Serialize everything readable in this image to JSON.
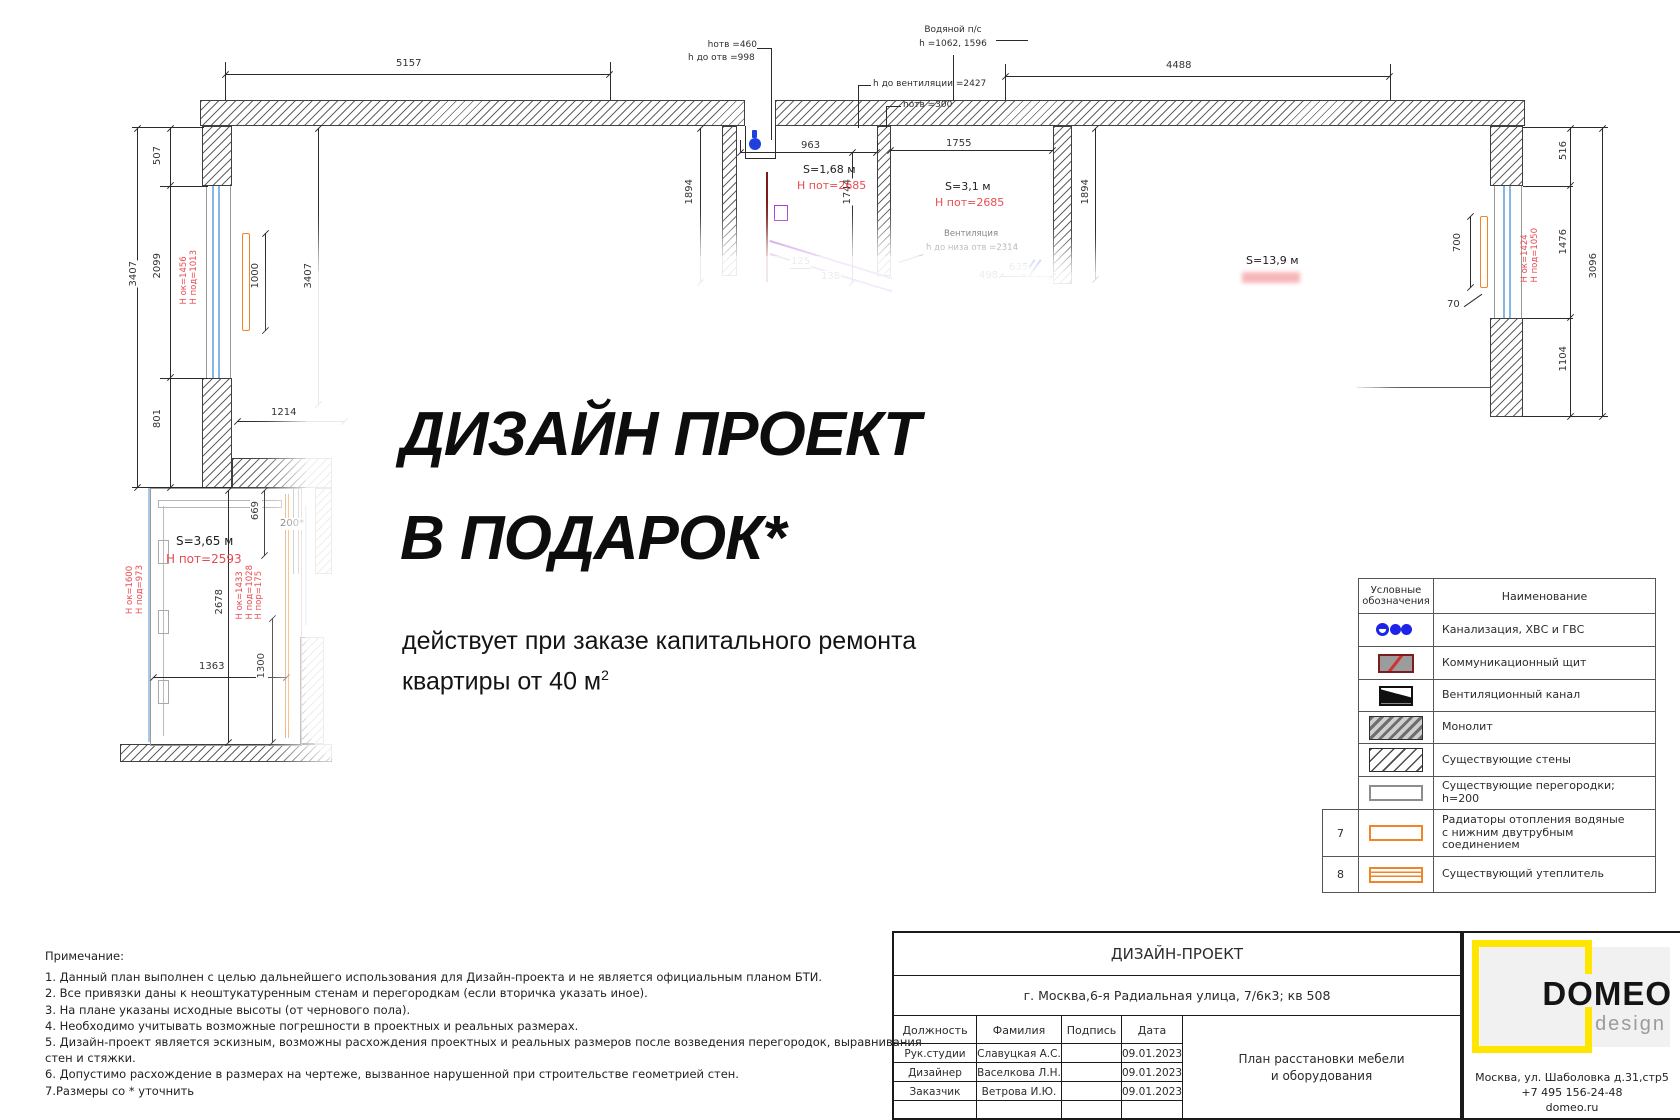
{
  "overlay": {
    "title_line1": "ДИЗАЙН ПРОЕКТ",
    "title_line2": "В ПОДАРОК*",
    "subtitle_line1": "действует при заказе капитального ремонта",
    "subtitle_line2": "квартиры от 40 м",
    "subtitle_sup": "2"
  },
  "plan": {
    "dims": {
      "d5157": "5157",
      "d4488": "4488",
      "d3407l": "3407",
      "d507": "507",
      "d2099": "2099",
      "d801": "801",
      "d3407i": "3407",
      "d1214": "1214",
      "d963": "963",
      "d1755": "1755",
      "d1894a": "1894",
      "d1744": "1744",
      "d1894b": "1894",
      "d635": "635",
      "d125": "125",
      "d138": "138",
      "d498": "498",
      "d516": "516",
      "d1476": "1476",
      "d1104": "1104",
      "d3096": "3096",
      "d700": "700",
      "d70": "70",
      "d1000": "1000",
      "d669": "669",
      "d200": "200*",
      "d2678": "2678",
      "d1363": "1363",
      "d1300": "1300"
    },
    "rooms": {
      "bath_s": "S=1,68 м",
      "bath_h": "Н пот=2685",
      "wc_s": "S=3,1 м",
      "wc_h": "Н пот=2685",
      "living_s": "S=13,9 м",
      "balcony_s": "S=3,65 м",
      "balcony_h": "Н пот=2593"
    },
    "red_marks": {
      "lw1": "Н ок=1456",
      "lw2": "Н под=1013",
      "bl1": "Н ок=1600",
      "bl2": "Н под=973",
      "bm1": "Н ок=1433",
      "bm2": "Н под=1028",
      "bm3": "Н пор=175",
      "rw1": "Н ок=1424",
      "rw2": "Н под=1050"
    },
    "annotations": {
      "a1a": "hотв =460",
      "a1b": "h до отв =998",
      "a2a": "Водяной п/с",
      "a2b": "h =1062, 1596",
      "a3": "h до вентиляции =2427",
      "a4": "hотв =300",
      "a5a": "Вентиляция",
      "a5b": "h до низа отв =2314"
    }
  },
  "legend": {
    "header_col1a": "Условные",
    "header_col1b": "обозначения",
    "header_col2": "Наименование",
    "rows": [
      {
        "icon": "sewer",
        "label": "Канализация, ХВС и ГВС"
      },
      {
        "icon": "comm",
        "label": "Коммуникационный щит"
      },
      {
        "icon": "vent",
        "label": "Вентиляционный канал"
      },
      {
        "icon": "monolith",
        "label": "Монолит"
      },
      {
        "icon": "walls",
        "label": "Существующие стены"
      },
      {
        "icon": "part",
        "label": "Существующие перегородки; h=200"
      },
      {
        "icon": "rad",
        "label": "Радиаторы отопления водяные\nс нижним двутрубным соединением",
        "num": "7"
      },
      {
        "icon": "ins",
        "label": "Существующий утеплитель",
        "num": "8"
      }
    ]
  },
  "titleblock": {
    "header": "ДИЗАЙН-ПРОЕКТ",
    "address": "г. Москва,6-я Радиальная улица, 7/6к3; кв 508",
    "columns": [
      "Должность",
      "Фамилия",
      "Подпись",
      "Дата"
    ],
    "rows": [
      [
        "Рук.студии",
        "Славуцкая А.С.",
        "",
        "09.01.2023"
      ],
      [
        "Дизайнер",
        "Васелкова Л.Н.",
        "",
        "09.01.2023"
      ],
      [
        "Заказчик",
        "Ветрова И.Ю.",
        "",
        "09.01.2023"
      ],
      [
        "",
        "",
        "",
        ""
      ]
    ],
    "drawing_name1": "План расстановки мебели",
    "drawing_name2": "и оборудования"
  },
  "logo": {
    "brand": "DOMEO",
    "sub": "design",
    "address": "Москва, ул. Шаболовка д.31,стр5",
    "phone": "+7 495 156-24-48",
    "site": "domeo.ru"
  },
  "notes": {
    "lines": [
      "Примечание:",
      "1. Данный план выполнен с целью дальнейшего использования для Дизайн-проекта и не является официальным планом БТИ.",
      "2. Все привязки даны к неоштукатуренным стенам и перегородкам (если вторичка указать иное).",
      "3. На плане указаны исходные высоты (от чернового пола).",
      "4. Необходимо учитывать возможные погрешности в проектных и реальных размерах.",
      "5. Дизайн-проект является эскизным, возможны расхождения проектных и реальных размеров после возведения перегородок, выравнивания",
      "стен и стяжки.",
      "6. Допустимо расхождение в размерах на чертеже, вызванное нарушенной при строительстве геометрией стен.",
      "7.Размеры со * уточнить"
    ]
  },
  "colors": {
    "accent_red": "#e84a50",
    "orange": "#f08428",
    "pipe_blue": "#1d24e8",
    "window_blue": "#86b7e4",
    "purple": "#a438d8",
    "brand_yellow": "#ffe600"
  }
}
